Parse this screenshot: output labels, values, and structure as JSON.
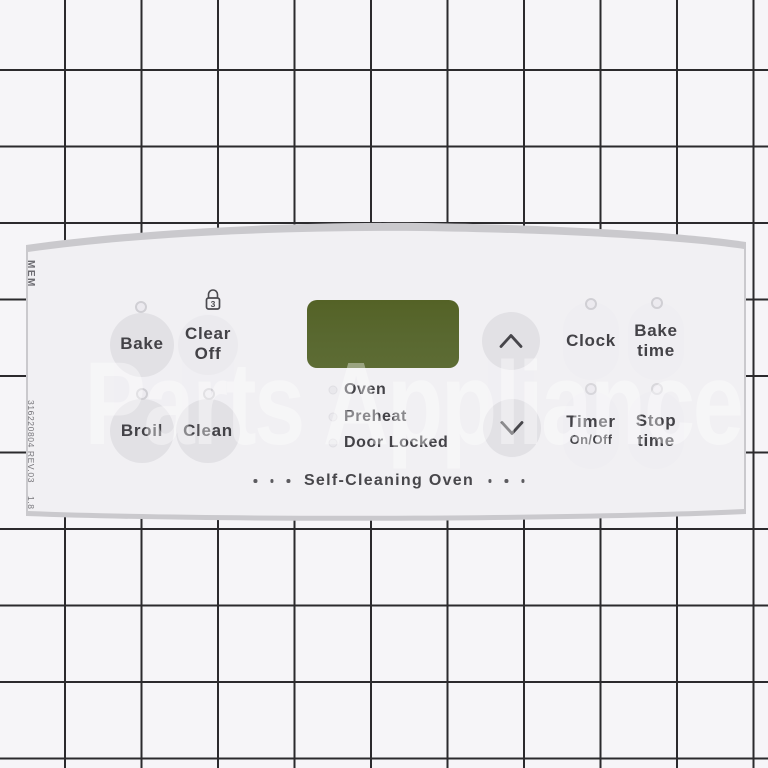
{
  "watermark": {
    "text": "Parts Appliance"
  },
  "colors": {
    "display_green": "#5a6930",
    "panel_white": "#f1f0f3",
    "grid_line": "#2b2a2d",
    "label_text": "#434247"
  },
  "panel": {
    "edge_labels": {
      "mem": "MEM",
      "part_number": "316220804 REV.03",
      "rev_extra": "1.8"
    },
    "icons": {
      "lock": "padlock-hold-3-icon",
      "up": "chevron-up-icon",
      "down": "chevron-down-icon"
    },
    "buttons": {
      "bake": "Bake",
      "clear_off": {
        "line1": "Clear",
        "line2": "Off",
        "lock_hold": "3"
      },
      "broil": "Broil",
      "clean": "Clean",
      "clock": "Clock",
      "bake_time": {
        "line1": "Bake",
        "line2": "time"
      },
      "timer": {
        "line1": "Timer",
        "line2": "On/Off"
      },
      "stop_time": {
        "line1": "Stop",
        "line2": "time"
      }
    },
    "indicators": [
      "Oven",
      "Preheat",
      "Door Locked"
    ],
    "footer": {
      "label": "Self-Cleaning Oven"
    }
  }
}
